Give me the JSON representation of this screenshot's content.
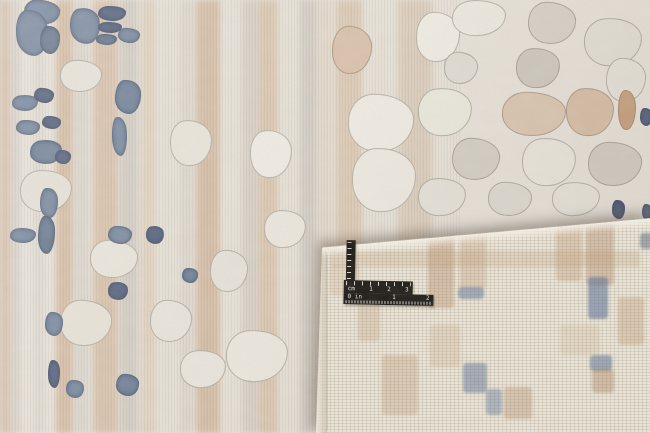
{
  "scene": {
    "description": "Close-up photo of an abstract cream, beige, grey and slate-blue area rug; bottom-right corner is folded over showing the woven backing, with a black L-shaped photographic scale ruler lying on the back",
    "width": 650,
    "height": 433
  },
  "palette": {
    "pile_base": "#e9e4db",
    "back_base": "#ece7da",
    "back_grid": "#d3ccc0",
    "tan": "#c69e79",
    "grey": "#b5afa4",
    "cream": "#f0ece3",
    "slate_blue": "#77889f",
    "navy_blue": "#53617e",
    "ruler_black": "#17140f",
    "ruler_marks": "#e8e8e8"
  },
  "ruler": {
    "cm_row": [
      "cm",
      "1",
      "2",
      "3"
    ],
    "in_row": [
      "0 in",
      "1",
      "2"
    ]
  },
  "rug_front": {
    "stripes": [
      {
        "x": 0,
        "w": 10,
        "c": "#c79e7c",
        "o": 0.5
      },
      {
        "x": 11,
        "w": 9,
        "c": "#bab4aa",
        "o": 0.35
      },
      {
        "x": 33,
        "w": 12,
        "c": "#cdc7bc",
        "o": 0.3
      },
      {
        "x": 56,
        "w": 17,
        "c": "#c69e79",
        "o": 0.55
      },
      {
        "x": 75,
        "w": 14,
        "c": "#bfb9ae",
        "o": 0.3
      },
      {
        "x": 93,
        "w": 25,
        "c": "#c9a27d",
        "o": 0.5
      },
      {
        "x": 120,
        "w": 18,
        "c": "#b3ada2",
        "o": 0.4
      },
      {
        "x": 141,
        "w": 15,
        "c": "#d4b493",
        "o": 0.35
      },
      {
        "x": 158,
        "w": 20,
        "c": "#e2ddd2",
        "o": 0.5
      },
      {
        "x": 180,
        "w": 13,
        "c": "#c2bcb1",
        "o": 0.3
      },
      {
        "x": 196,
        "w": 24,
        "c": "#c69f7b",
        "o": 0.55
      },
      {
        "x": 224,
        "w": 16,
        "c": "#e6e1d7",
        "o": 0.5
      },
      {
        "x": 242,
        "w": 16,
        "c": "#b7b1a6",
        "o": 0.35
      },
      {
        "x": 258,
        "w": 20,
        "c": "#cca87f",
        "o": 0.45
      },
      {
        "x": 280,
        "w": 18,
        "c": "#e4dfd4",
        "o": 0.45
      },
      {
        "x": 300,
        "w": 17,
        "c": "#b5afa4",
        "o": 0.4
      },
      {
        "x": 318,
        "w": 14,
        "c": "#d9c3a8",
        "o": 0.3
      },
      {
        "x": 336,
        "w": 26,
        "c": "#cda882",
        "o": 0.4
      },
      {
        "x": 366,
        "w": 28,
        "c": "#e8e3d9",
        "o": 0.5
      },
      {
        "x": 398,
        "w": 34,
        "c": "#c8ab8a",
        "o": 0.35
      }
    ],
    "patches": [
      {
        "x": 416,
        "y": 12,
        "w": 42,
        "h": 48,
        "c": "#f1eee6",
        "r": 2
      },
      {
        "x": 452,
        "y": 0,
        "w": 52,
        "h": 34,
        "c": "#eeebe2",
        "r": -2
      },
      {
        "x": 528,
        "y": 2,
        "w": 46,
        "h": 40,
        "c": "#d8d3ca",
        "r": 3
      },
      {
        "x": 584,
        "y": 18,
        "w": 56,
        "h": 46,
        "c": "#e5e1d8",
        "r": -3
      },
      {
        "x": 444,
        "y": 52,
        "w": 32,
        "h": 30,
        "c": "#e2ded5",
        "r": 4
      },
      {
        "x": 516,
        "y": 48,
        "w": 42,
        "h": 38,
        "c": "#cfcac1",
        "r": -2
      },
      {
        "x": 606,
        "y": 58,
        "w": 38,
        "h": 42,
        "c": "#e8e4db",
        "r": 2
      },
      {
        "x": 418,
        "y": 88,
        "w": 52,
        "h": 46,
        "c": "#eceade",
        "r": -3
      },
      {
        "x": 502,
        "y": 92,
        "w": 62,
        "h": 42,
        "c": "#dcc7b1",
        "r": 2
      },
      {
        "x": 566,
        "y": 88,
        "w": 46,
        "h": 46,
        "c": "#d8bfa6",
        "r": -2
      },
      {
        "x": 618,
        "y": 90,
        "w": 16,
        "h": 38,
        "c": "#c79e7c",
        "r": 0
      },
      {
        "x": 452,
        "y": 138,
        "w": 46,
        "h": 40,
        "c": "#d5d0c7",
        "r": 3
      },
      {
        "x": 522,
        "y": 138,
        "w": 52,
        "h": 46,
        "c": "#ece8df",
        "r": -2
      },
      {
        "x": 588,
        "y": 142,
        "w": 52,
        "h": 42,
        "c": "#d2cdc4",
        "r": 2
      },
      {
        "x": 418,
        "y": 178,
        "w": 46,
        "h": 36,
        "c": "#e7e3da",
        "r": -2
      },
      {
        "x": 488,
        "y": 182,
        "w": 42,
        "h": 32,
        "c": "#dfdbd2",
        "r": 3
      },
      {
        "x": 552,
        "y": 182,
        "w": 46,
        "h": 32,
        "c": "#e9e5dc",
        "r": -3
      },
      {
        "x": 348,
        "y": 94,
        "w": 64,
        "h": 56,
        "c": "#f0ede5",
        "r": 2
      },
      {
        "x": 352,
        "y": 148,
        "w": 62,
        "h": 62,
        "c": "#efebe2",
        "r": -1
      },
      {
        "x": 332,
        "y": 26,
        "w": 38,
        "h": 46,
        "c": "#d9c2ab",
        "r": 3
      },
      {
        "x": 226,
        "y": 330,
        "w": 60,
        "h": 50,
        "c": "#ece8df",
        "r": -2
      },
      {
        "x": 150,
        "y": 300,
        "w": 40,
        "h": 40,
        "c": "#e8e4db",
        "r": 3
      },
      {
        "x": 250,
        "y": 130,
        "w": 40,
        "h": 46,
        "c": "#efece4",
        "r": -2
      },
      {
        "x": 210,
        "y": 250,
        "w": 36,
        "h": 40,
        "c": "#e6e2d9",
        "r": 2
      },
      {
        "x": 264,
        "y": 210,
        "w": 40,
        "h": 36,
        "c": "#ebe7de",
        "r": -3
      },
      {
        "x": 60,
        "y": 60,
        "w": 40,
        "h": 30,
        "c": "#e8e3d9",
        "r": 2
      },
      {
        "x": 20,
        "y": 170,
        "w": 50,
        "h": 40,
        "c": "#e6e1d7",
        "r": -2
      },
      {
        "x": 90,
        "y": 240,
        "w": 46,
        "h": 36,
        "c": "#eae5db",
        "r": 3
      },
      {
        "x": 170,
        "y": 120,
        "w": 40,
        "h": 44,
        "c": "#e9e4da",
        "r": -2
      },
      {
        "x": 60,
        "y": 300,
        "w": 50,
        "h": 44,
        "c": "#e7e2d8",
        "r": 2
      },
      {
        "x": 180,
        "y": 350,
        "w": 44,
        "h": 36,
        "c": "#e9e5dc",
        "r": -2
      }
    ],
    "blue_patches": [
      {
        "x": 24,
        "y": 0,
        "w": 34,
        "h": 22,
        "r": 6,
        "c": "#77889f"
      },
      {
        "x": 16,
        "y": 10,
        "w": 30,
        "h": 44,
        "r": -4,
        "c": "#77889f"
      },
      {
        "x": 40,
        "y": 26,
        "w": 18,
        "h": 26,
        "r": 3,
        "c": "#66788f"
      },
      {
        "x": 70,
        "y": 8,
        "w": 28,
        "h": 34,
        "r": -5,
        "c": "#77889f"
      },
      {
        "x": 98,
        "y": 6,
        "w": 26,
        "h": 13,
        "r": 0,
        "c": "#53617e"
      },
      {
        "x": 98,
        "y": 22,
        "w": 22,
        "h": 9,
        "r": 0,
        "c": "#53617e"
      },
      {
        "x": 96,
        "y": 34,
        "w": 19,
        "h": 9,
        "r": 0,
        "c": "#66788f"
      },
      {
        "x": 118,
        "y": 28,
        "w": 20,
        "h": 13,
        "r": 4,
        "c": "#77889f"
      },
      {
        "x": 12,
        "y": 95,
        "w": 24,
        "h": 14,
        "r": -3,
        "c": "#77889f"
      },
      {
        "x": 34,
        "y": 88,
        "w": 18,
        "h": 13,
        "r": 5,
        "c": "#53617e"
      },
      {
        "x": 115,
        "y": 80,
        "w": 24,
        "h": 32,
        "r": 2,
        "c": "#6d7f96"
      },
      {
        "x": 112,
        "y": 117,
        "w": 13,
        "h": 37,
        "r": -2,
        "c": "#77889f"
      },
      {
        "x": 16,
        "y": 120,
        "w": 22,
        "h": 13,
        "r": 0,
        "c": "#77889f"
      },
      {
        "x": 42,
        "y": 116,
        "w": 17,
        "h": 11,
        "r": 3,
        "c": "#53617e"
      },
      {
        "x": 30,
        "y": 140,
        "w": 30,
        "h": 22,
        "r": -4,
        "c": "#6d7f96"
      },
      {
        "x": 55,
        "y": 150,
        "w": 14,
        "h": 12,
        "r": 2,
        "c": "#53617e"
      },
      {
        "x": 40,
        "y": 188,
        "w": 16,
        "h": 28,
        "r": 0,
        "c": "#77889f"
      },
      {
        "x": 38,
        "y": 216,
        "w": 15,
        "h": 36,
        "r": 2,
        "c": "#66788f"
      },
      {
        "x": 10,
        "y": 228,
        "w": 24,
        "h": 13,
        "r": -2,
        "c": "#77889f"
      },
      {
        "x": 108,
        "y": 226,
        "w": 22,
        "h": 16,
        "r": 3,
        "c": "#77889f"
      },
      {
        "x": 146,
        "y": 226,
        "w": 16,
        "h": 16,
        "r": -4,
        "c": "#53617e"
      },
      {
        "x": 182,
        "y": 268,
        "w": 14,
        "h": 13,
        "r": 0,
        "c": "#6d7f96"
      },
      {
        "x": 108,
        "y": 282,
        "w": 18,
        "h": 16,
        "r": -3,
        "c": "#53617e"
      },
      {
        "x": 45,
        "y": 312,
        "w": 16,
        "h": 22,
        "r": 2,
        "c": "#77889f"
      },
      {
        "x": 48,
        "y": 360,
        "w": 10,
        "h": 26,
        "r": 0,
        "c": "#53617e"
      },
      {
        "x": 66,
        "y": 380,
        "w": 16,
        "h": 16,
        "r": -3,
        "c": "#77889f"
      },
      {
        "x": 116,
        "y": 374,
        "w": 21,
        "h": 20,
        "r": 4,
        "c": "#6d7f96"
      },
      {
        "x": 640,
        "y": 108,
        "w": 10,
        "h": 16,
        "r": 0,
        "c": "#53617e"
      },
      {
        "x": 612,
        "y": 200,
        "w": 11,
        "h": 17,
        "r": 0,
        "c": "#4a5874"
      },
      {
        "x": 642,
        "y": 204,
        "w": 8,
        "h": 14,
        "r": 0,
        "c": "#53617e"
      }
    ]
  },
  "rug_back": {
    "patches": [
      {
        "x": 118,
        "y": 18,
        "w": 26,
        "h": 85,
        "c": "rgba(178,132,96,0.40)"
      },
      {
        "x": 150,
        "y": 22,
        "w": 26,
        "h": 62,
        "c": "rgba(190,150,112,0.32)"
      },
      {
        "x": 148,
        "y": 82,
        "w": 26,
        "h": 12,
        "c": "rgba(92,117,152,0.55)"
      },
      {
        "x": 246,
        "y": 18,
        "w": 26,
        "h": 58,
        "c": "rgba(185,143,104,0.35)"
      },
      {
        "x": 276,
        "y": 16,
        "w": 28,
        "h": 64,
        "c": "rgba(172,128,92,0.40)"
      },
      {
        "x": 278,
        "y": 72,
        "w": 20,
        "h": 42,
        "c": "rgba(88,112,148,0.60)"
      },
      {
        "x": 280,
        "y": 150,
        "w": 22,
        "h": 16,
        "c": "rgba(86,110,146,0.55)"
      },
      {
        "x": 282,
        "y": 164,
        "w": 22,
        "h": 24,
        "c": "rgba(168,124,88,0.40)"
      },
      {
        "x": 153,
        "y": 158,
        "w": 24,
        "h": 30,
        "c": "rgba(90,114,150,0.50)"
      },
      {
        "x": 176,
        "y": 184,
        "w": 16,
        "h": 26,
        "c": "rgba(94,118,154,0.45)"
      },
      {
        "x": 194,
        "y": 182,
        "w": 28,
        "h": 32,
        "c": "rgba(180,138,100,0.38)"
      },
      {
        "x": 308,
        "y": 92,
        "w": 26,
        "h": 48,
        "c": "rgba(185,143,104,0.35)"
      },
      {
        "x": 330,
        "y": 28,
        "w": 14,
        "h": 16,
        "c": "rgba(80,96,126,0.50)"
      },
      {
        "x": 48,
        "y": 92,
        "w": 22,
        "h": 44,
        "c": "rgba(190,150,112,0.28)"
      },
      {
        "x": 72,
        "y": 150,
        "w": 36,
        "h": 60,
        "c": "rgba(182,140,102,0.30)"
      },
      {
        "x": 120,
        "y": 120,
        "w": 30,
        "h": 42,
        "c": "rgba(195,158,120,0.25)"
      },
      {
        "x": 20,
        "y": 60,
        "w": 30,
        "h": 30,
        "c": "rgba(195,158,120,0.22)"
      },
      {
        "x": 250,
        "y": 120,
        "w": 40,
        "h": 30,
        "c": "rgba(200,165,128,0.20)"
      },
      {
        "x": 20,
        "y": 46,
        "w": 310,
        "h": 16,
        "c": "rgba(188,150,112,0.25)"
      }
    ]
  }
}
